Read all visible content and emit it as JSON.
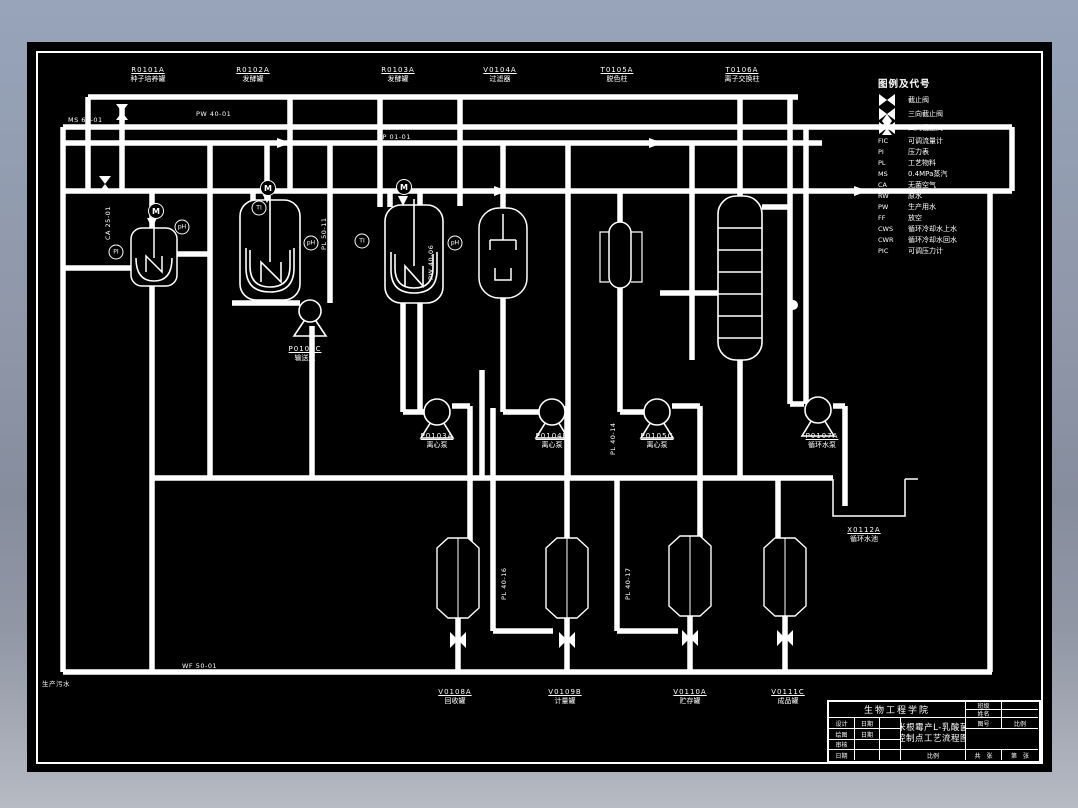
{
  "window": {
    "canvas_bg": "#000000",
    "line_color": "#ffffff",
    "backdrop_top": "#97a4ba",
    "backdrop_bottom": "#b6bac3"
  },
  "legend": {
    "title": "图例及代号",
    "symbol_items": [
      {
        "icon": "globe-valve-icon",
        "label": "截止阀"
      },
      {
        "icon": "three-way-valve-icon",
        "label": "三向截止阀"
      },
      {
        "icon": "four-way-valve-icon",
        "label": "四向截止阀"
      }
    ],
    "code_items": [
      {
        "code": "FIC",
        "label": "可调流量计"
      },
      {
        "code": "PI",
        "label": "压力表"
      },
      {
        "code": "PL",
        "label": "工艺物料"
      },
      {
        "code": "MS",
        "label": "0.4MPa蒸汽"
      },
      {
        "code": "CA",
        "label": "无菌空气"
      },
      {
        "code": "RW",
        "label": "原水"
      },
      {
        "code": "PW",
        "label": "生产用水"
      },
      {
        "code": "FF",
        "label": "放空"
      },
      {
        "code": "CWS",
        "label": "循环冷却水上水"
      },
      {
        "code": "CWR",
        "label": "循环冷却水回水"
      },
      {
        "code": "PIC",
        "label": "可调压力计"
      }
    ]
  },
  "title_block": {
    "org": "生物工程学院",
    "title_line1": "米根霉产L-乳酸菌",
    "title_line2": "控制点工艺流程图",
    "rows_left": [
      {
        "c1": "设计",
        "c2": "日期"
      },
      {
        "c1": "绘图",
        "c2": "日期"
      },
      {
        "c1": "审核",
        "c2": ""
      },
      {
        "c1": "日期",
        "c2": ""
      }
    ],
    "right": {
      "r1": "班级",
      "r1v": "",
      "r2": "姓名",
      "r2v": "",
      "r3a": "图号",
      "r3b": "比例",
      "bottom_left": "共　张",
      "bottom_right": "第　张"
    },
    "scale_cell": "比例"
  },
  "equipment_labels": [
    {
      "tag": "R0101A",
      "name": "种子培养罐",
      "x": 148,
      "y": 66
    },
    {
      "tag": "R0102A",
      "name": "发酵罐",
      "x": 253,
      "y": 66
    },
    {
      "tag": "R0103A",
      "name": "发酵罐",
      "x": 398,
      "y": 66
    },
    {
      "tag": "V0104A",
      "name": "过滤器",
      "x": 500,
      "y": 66
    },
    {
      "tag": "T0105A",
      "name": "脱色柱",
      "x": 617,
      "y": 66
    },
    {
      "tag": "T0106A",
      "name": "离子交换柱",
      "x": 742,
      "y": 66
    },
    {
      "tag": "P0102C",
      "name": "输送泵",
      "x": 305,
      "y": 345
    },
    {
      "tag": "P0103A",
      "name": "离心泵",
      "x": 437,
      "y": 432
    },
    {
      "tag": "P0104B",
      "name": "离心泵",
      "x": 552,
      "y": 432
    },
    {
      "tag": "P0105C",
      "name": "离心泵",
      "x": 657,
      "y": 432
    },
    {
      "tag": "P0107A",
      "name": "循环水泵",
      "x": 822,
      "y": 432
    },
    {
      "tag": "V0108A",
      "name": "回收罐",
      "x": 455,
      "y": 688
    },
    {
      "tag": "V0109B",
      "name": "计量罐",
      "x": 565,
      "y": 688
    },
    {
      "tag": "V0110A",
      "name": "贮存罐",
      "x": 690,
      "y": 688
    },
    {
      "tag": "V0111C",
      "name": "成品罐",
      "x": 788,
      "y": 688
    },
    {
      "tag": "X0112A",
      "name": "循环水池",
      "x": 864,
      "y": 526
    }
  ],
  "pipe_labels": [
    {
      "text": "MS 65-01",
      "x": 68,
      "y": 116,
      "vertical": false
    },
    {
      "text": "PW 40-01",
      "x": 196,
      "y": 110,
      "vertical": false
    },
    {
      "text": "TP 01-01",
      "x": 378,
      "y": 133,
      "vertical": false
    },
    {
      "text": "CA 25-01",
      "x": 104,
      "y": 240,
      "vertical": true
    },
    {
      "text": "PL 50-11",
      "x": 320,
      "y": 250,
      "vertical": true
    },
    {
      "text": "PW 40-06",
      "x": 427,
      "y": 280,
      "vertical": true
    },
    {
      "text": "PL 40-13",
      "x": 688,
      "y": 230,
      "vertical": true
    },
    {
      "text": "PW 40-21",
      "x": 786,
      "y": 260,
      "vertical": true
    },
    {
      "text": "CWS 40-22",
      "x": 802,
      "y": 265,
      "vertical": true
    },
    {
      "text": "CWS 40-30",
      "x": 478,
      "y": 455,
      "vertical": true
    },
    {
      "text": "PL 40-14",
      "x": 609,
      "y": 455,
      "vertical": true
    },
    {
      "text": "CWR 40-30",
      "x": 841,
      "y": 490,
      "vertical": true
    },
    {
      "text": "PL 40-16",
      "x": 500,
      "y": 600,
      "vertical": true
    },
    {
      "text": "PL 40-17",
      "x": 624,
      "y": 600,
      "vertical": true
    },
    {
      "text": "WF 50-01",
      "x": 182,
      "y": 662,
      "vertical": false
    },
    {
      "text": "生产污水",
      "x": 42,
      "y": 678,
      "vertical": false
    }
  ],
  "instruments": [
    {
      "text": "M",
      "x": 268,
      "y": 188,
      "motor": true
    },
    {
      "text": "M",
      "x": 404,
      "y": 187,
      "motor": true
    },
    {
      "text": "M",
      "x": 156,
      "y": 211,
      "motor": true
    },
    {
      "text": "TI",
      "x": 259,
      "y": 208,
      "motor": false
    },
    {
      "text": "pH",
      "x": 311,
      "y": 243,
      "motor": false
    },
    {
      "text": "TI",
      "x": 362,
      "y": 241,
      "motor": false
    },
    {
      "text": "pH",
      "x": 455,
      "y": 243,
      "motor": false
    },
    {
      "text": "PI",
      "x": 116,
      "y": 252,
      "motor": false
    },
    {
      "text": "pH",
      "x": 182,
      "y": 227,
      "motor": false
    }
  ]
}
